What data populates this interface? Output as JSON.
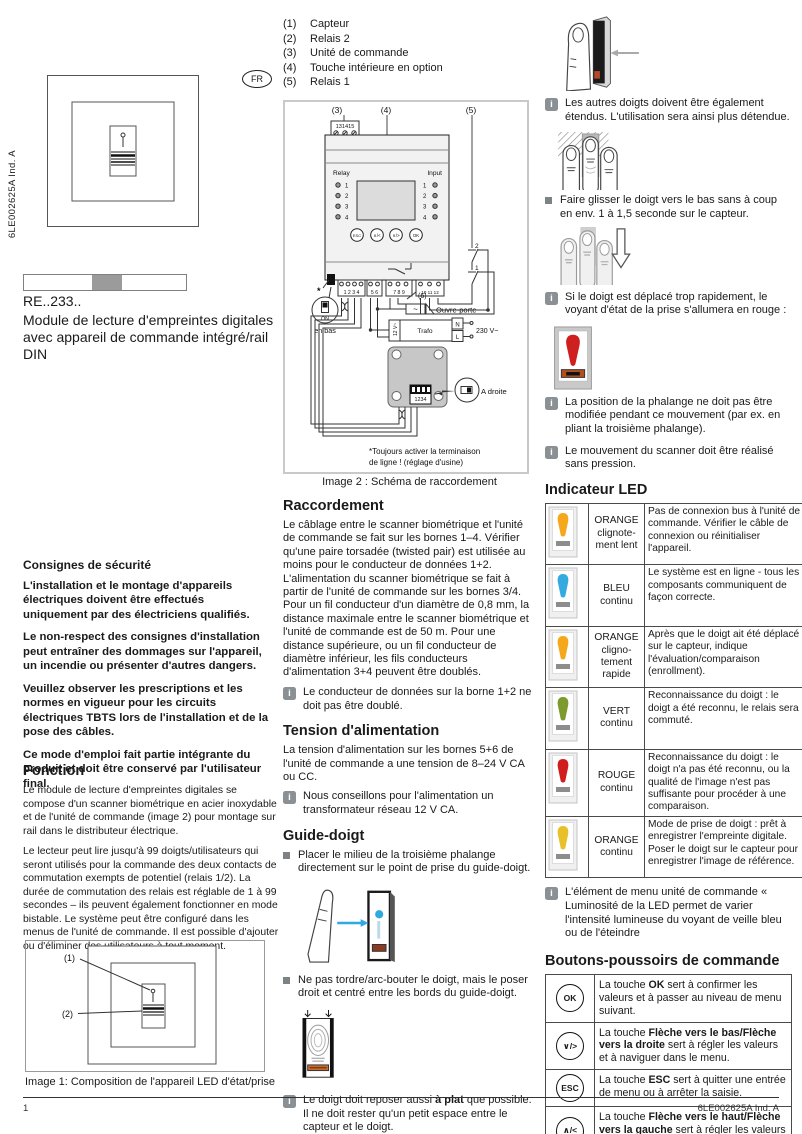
{
  "meta": {
    "doc_ref": "6LE002625A Ind. A",
    "page_number": "1",
    "lang_badge": "FR"
  },
  "colors": {
    "accent_blue": "#2FA9DF",
    "alert_red": "#CF1F1F",
    "bar_orange": "#B34F1F"
  },
  "left": {
    "product_code": "RE..233..",
    "product_title": "Module de lecture d'empreintes digitales avec appareil de commande intégré/rail DIN",
    "safety": {
      "heading": "Consignes de sécurité",
      "p1": "L'installation et le montage d'appareils électriques doivent être effectués uniquement par des électriciens qualifiés.",
      "p2": "Le non-respect des consignes d'installation peut entraîner des dommages sur l'appareil, un incendie ou présenter d'autres dangers.",
      "p3": "Veuillez observer les prescriptions et les normes en vigueur pour les circuits électriques TBTS lors de l'installation et de la pose des câbles.",
      "p4": "Ce mode d'emploi fait partie intégrante du produit et doit être conservé par l'utilisateur final."
    },
    "fonction": {
      "heading": "Fonction",
      "p1": "Le module de lecture d'empreintes digitales se compose d'un scanner biométrique en acier inoxydable et de l'unité de commande (image 2) pour montage sur rail dans le distributeur électrique.",
      "p2": "Le lecteur peut lire jusqu'à 99 doigts/utilisateurs qui seront utilisés pour la commande des deux contacts de commutation exempts de potentiel (relais 1/2). La durée de commutation des relais est réglable de 1 à 99 secondes – ils peuvent également fonctionner en mode bistable. Le système peut être configuré dans les menus de l'unité de commande. Il est possible d'ajouter ou d'éliminer des utilisateurs à tout moment."
    },
    "image1": {
      "label1": "(1)",
      "label2": "(2)",
      "caption": "Image 1: Composition de l'appareil LED d'état/prise"
    }
  },
  "legend": {
    "items": [
      {
        "num": "(1)",
        "label": "Capteur"
      },
      {
        "num": "(2)",
        "label": "Relais 2"
      },
      {
        "num": "(3)",
        "label": "Unité de commande"
      },
      {
        "num": "(4)",
        "label": "Touche intérieure en option"
      },
      {
        "num": "(5)",
        "label": "Relais 1"
      }
    ]
  },
  "diagram": {
    "caption": "Image 2 : Schéma de raccordement",
    "label3": "(3)",
    "label4": "(4)",
    "label5": "(5)",
    "label6": "(6)",
    "top_terminals": "131415",
    "relay_label": "Relay",
    "input_label": "Input",
    "relay_1": "1",
    "relay_2": "2",
    "relay_3": "3",
    "relay_4": "4",
    "input_1": "1",
    "input_2": "2",
    "input_3": "3",
    "input_4": "4",
    "btn_esc": "ESC",
    "btn_up": "∧/<",
    "btn_down": "∨/>",
    "btn_ok": "OK",
    "terminals_a": "1 2 3 4",
    "terminals_b": "5 6",
    "terminals_c": "7 8 9",
    "terminals_d": "10 11 12",
    "asterisk": "*",
    "on_label": "ON",
    "en_bas": "en bas",
    "ouvre_porte": "Ouvre-porte",
    "bell_wave": "~",
    "trafo": "Trafo",
    "twelve_v": "12 V~",
    "n_label": "N",
    "l_label": "L",
    "mains": "230 V~",
    "dip_numbers": "1234",
    "a_droite": "A droite",
    "sw2": "2",
    "sw1": "1",
    "footnote_line1": "*Toujours activer la terminaison",
    "footnote_line2": "de ligne ! (réglage d'usine)"
  },
  "middle": {
    "raccordement": {
      "heading": "Raccordement",
      "body": "Le câblage entre le scanner biométrique et l'unité de commande se fait sur les bornes 1–4. Vérifier qu'une paire torsadée (twisted pair) est utilisée au moins pour le conducteur de données 1+2. L'alimentation du scanner biométrique se fait à partir de l'unité de commande sur les bornes 3/4. Pour un fil conducteur d'un diamètre de 0,8 mm, la distance maximale entre le scanner biométrique et l'unité de commande est de 50 m. Pour une distance supérieure, ou un fil conducteur de diamètre inférieur, les fils conducteurs d'alimentation 3+4 peuvent être doublés.",
      "note": "Le conducteur de données sur la borne 1+2 ne doit pas être doublé."
    },
    "tension": {
      "heading": "Tension d'alimentation",
      "body": "La tension d'alimentation sur les bornes 5+6 de l'unité de commande a une tension de 8–24 V CA ou CC.",
      "note": "Nous conseillons pour l'alimentation un transformateur réseau 12 V CA."
    },
    "guide": {
      "heading": "Guide-doigt",
      "bullet1": "Placer le milieu de la troisième phalange directement sur le point de prise du guide-doigt.",
      "bullet2": "Ne pas tordre/arc-bouter le doigt, mais le poser droit et centré entre les bords du guide-doigt.",
      "note_pre": "Le doigt doit reposer aussi ",
      "note_bold": "à plat",
      "note_post": " que possible. Il ne doit rester qu'un petit espace entre le capteur et le doigt."
    }
  },
  "right": {
    "note1": "Les autres doigts doivent être également étendus. L'utilisation sera ainsi plus détendue.",
    "bullet1": "Faire glisser le doigt vers le bas sans à coup en env. 1 à 1,5 seconde sur le capteur.",
    "note2": "Si le doigt est déplacé trop rapidement, le voyant d'état de la prise s'allumera en rouge :",
    "note3": "La position de la phalange ne doit pas être modifiée pendant ce mouvement (par ex. en pliant la troisième phalange).",
    "note4": "Le mouvement du scanner doit être réalisé sans pression.",
    "led": {
      "heading": "Indicateur LED",
      "rows": [
        {
          "color": "#F5A81C",
          "state": "ORANGE clignote-ment lent",
          "desc": "Pas de connexion bus à l'unité de commande. Vérifier le câble de connexion ou réinitialiser l'appareil."
        },
        {
          "color": "#35AADF",
          "state": "BLEU continu",
          "desc": "Le système est en ligne - tous les composants communiquent de façon correcte."
        },
        {
          "color": "#F5A81C",
          "state": "ORANGE cligno-tement rapide",
          "desc": "Après que le doigt ait été déplacé sur le capteur, indique l'évaluation/comparaison (enrollment)."
        },
        {
          "color": "#7C9A2D",
          "state": "VERT continu",
          "desc": "Reconnaissance du doigt : le doigt a été reconnu, le relais sera commuté."
        },
        {
          "color": "#D01E1E",
          "state": "ROUGE continu",
          "desc": "Reconnaissance du doigt : le doigt n'a pas été reconnu, ou la qualité de l'image n'est pas suffisante pour procéder à une comparaison."
        },
        {
          "color": "#E8C02A",
          "state": "ORANGE continu",
          "desc": "Mode de prise de doigt : prêt à enregistrer l'empreinte digitale. Poser le doigt sur le capteur pour enregistrer l'image de référence."
        }
      ]
    },
    "note5": "L'élément de menu unité de commande « Luminosité de la LED  permet de varier l'intensité lumineuse du voyant de veille bleu ou de l'éteindre",
    "buttons": {
      "heading": "Boutons-poussoirs de commande",
      "rows": [
        {
          "key": "OK",
          "pre": "La touche ",
          "bold": "OK",
          "post": " sert à confirmer les valeurs et à passer au niveau de menu suivant."
        },
        {
          "key": "∨/>",
          "pre": "La touche ",
          "bold": "Flèche vers le bas/Flèche vers la droite",
          "post": " sert à régler les valeurs et à naviguer dans le menu."
        },
        {
          "key": "ESC",
          "pre": "La touche ",
          "bold": "ESC",
          "post": " sert à quitter une entrée de menu ou à arrêter la saisie."
        },
        {
          "key": "∧/<",
          "pre": "La touche ",
          "bold": "Flèche vers le haut/Flèche vers la gauche",
          "post": " sert à régler les valeurs et à naviguer dans le menu."
        }
      ]
    }
  }
}
